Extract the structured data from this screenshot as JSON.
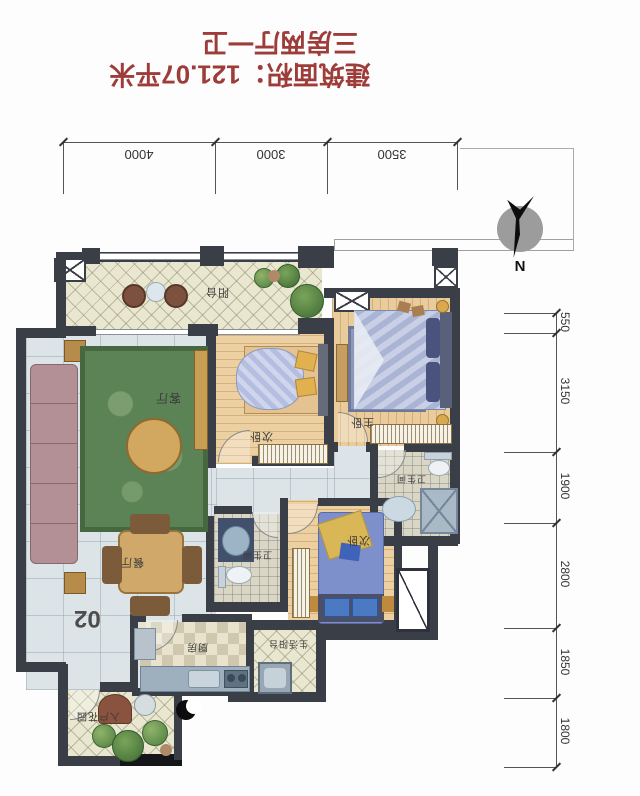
{
  "header": {
    "layout_type": "三房两厅一卫",
    "area_text": "建筑面积：121.07平米"
  },
  "compass": {
    "label": "N"
  },
  "dims": {
    "top": [
      "4000",
      "3000",
      "3500"
    ],
    "right": [
      "550",
      "3150",
      "1900",
      "2800",
      "1850",
      "1800"
    ]
  },
  "rooms": {
    "balcony": "阳台",
    "living": "客厅",
    "dining": "餐厅",
    "bedroom_mid": "次卧",
    "bedroom_master": "主卧",
    "bath_master": "卫生间",
    "bath_common": "卫生间",
    "bedroom_south": "次卧",
    "kitchen": "厨房",
    "service_balcony": "生活阳台",
    "entry_garden": "入户花园"
  },
  "unit_number": "02",
  "colors": {
    "title_red": "#9d3c39",
    "wall_dark": "#3a3e47",
    "floor_wood": "#ecd0a2",
    "floor_cream": "#eae7d1",
    "floor_blue": "#dde4e7"
  }
}
